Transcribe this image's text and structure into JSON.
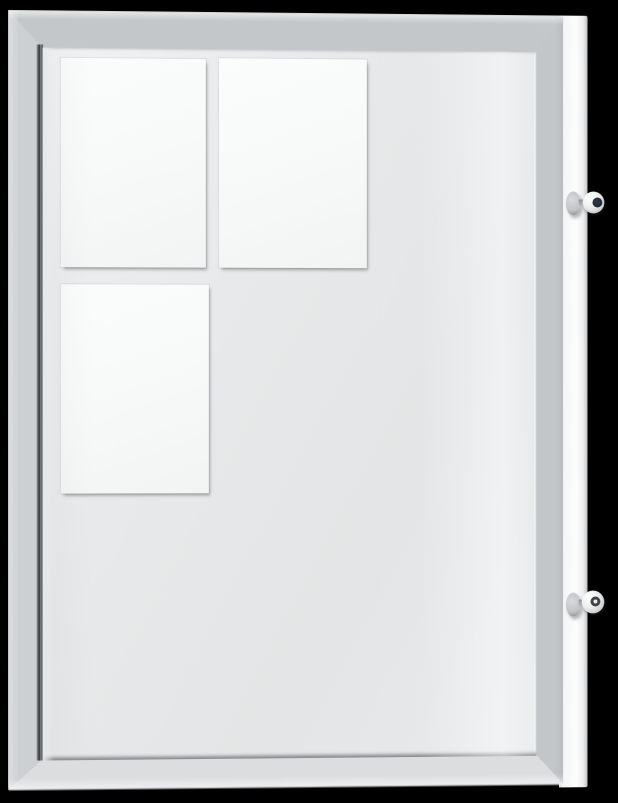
{
  "image": {
    "type": "product-photograph",
    "subject": "Wall-mounted lockable display case with silver aluminium frame, three blank white sheets on a grey backing board, and two cylinder cam locks with inserted keys on the right side",
    "text_content": "none"
  },
  "scene": {
    "background": "black",
    "display_case": {
      "frame": "silver aluminium, mitered corners",
      "door": "glass front with hinge gap on left edge",
      "backing_board": "light grey",
      "papers_count": 3,
      "papers": [
        {
          "position": "top-left",
          "state": "blank"
        },
        {
          "position": "top-middle",
          "state": "blank"
        },
        {
          "position": "middle-left",
          "state": "blank"
        }
      ],
      "locks_count": 2,
      "locks": [
        {
          "position": "upper-right-side",
          "key_inserted": true
        },
        {
          "position": "lower-right-side",
          "key_inserted": true
        }
      ]
    }
  },
  "colors": {
    "background": "#000000",
    "frame-top": "#c3c7ca",
    "frame-left": "#ccd0d2",
    "frame-right": "#c2c6c8",
    "frame-bottom": "#dbdddf",
    "backing": "#e6e8e9",
    "backing-light": "#f2f3f4",
    "paper": "#f8f9f9",
    "side-panel": "#fafbfb",
    "gap-dark": "#33383b",
    "key-hole-dark": "#1f2733",
    "metal-mid": "#c0c4c7"
  }
}
